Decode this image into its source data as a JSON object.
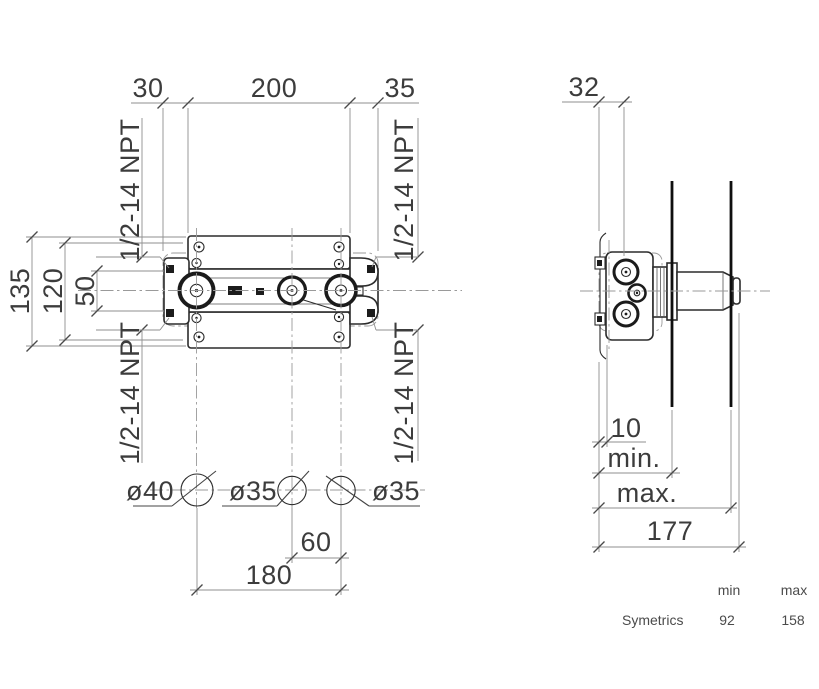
{
  "front_view": {
    "dim_top_left": "30",
    "dim_top_center": "200",
    "dim_top_right": "35",
    "dim_height_outer": "135",
    "dim_height_mid": "120",
    "dim_height_inner": "50",
    "dim_bottom_inner": "60",
    "dim_bottom_outer": "180",
    "port_labels": {
      "top_left": "1/2-14 NPT",
      "top_right": "1/2-14 NPT",
      "bottom_left": "1/2-14 NPT",
      "bottom_right": "1/2-14 NPT"
    },
    "holes": {
      "left": "ø40",
      "center": "ø35",
      "right": "ø35"
    }
  },
  "side_view": {
    "dim_depth_offset": "32",
    "dim_plaster_min_offset": "10",
    "label_min": "min.",
    "label_max": "max.",
    "dim_total_depth": "177"
  },
  "spec_table": {
    "col_min": "min",
    "col_max": "max",
    "rows": [
      {
        "name": "Symetrics",
        "min": "92",
        "max": "158"
      }
    ]
  },
  "colors": {
    "line": "#2c2c2c",
    "dimension_line": "#8f8f8f",
    "text": "#3c3c3c",
    "table_text": "#4b4b4b",
    "background": "#ffffff"
  }
}
